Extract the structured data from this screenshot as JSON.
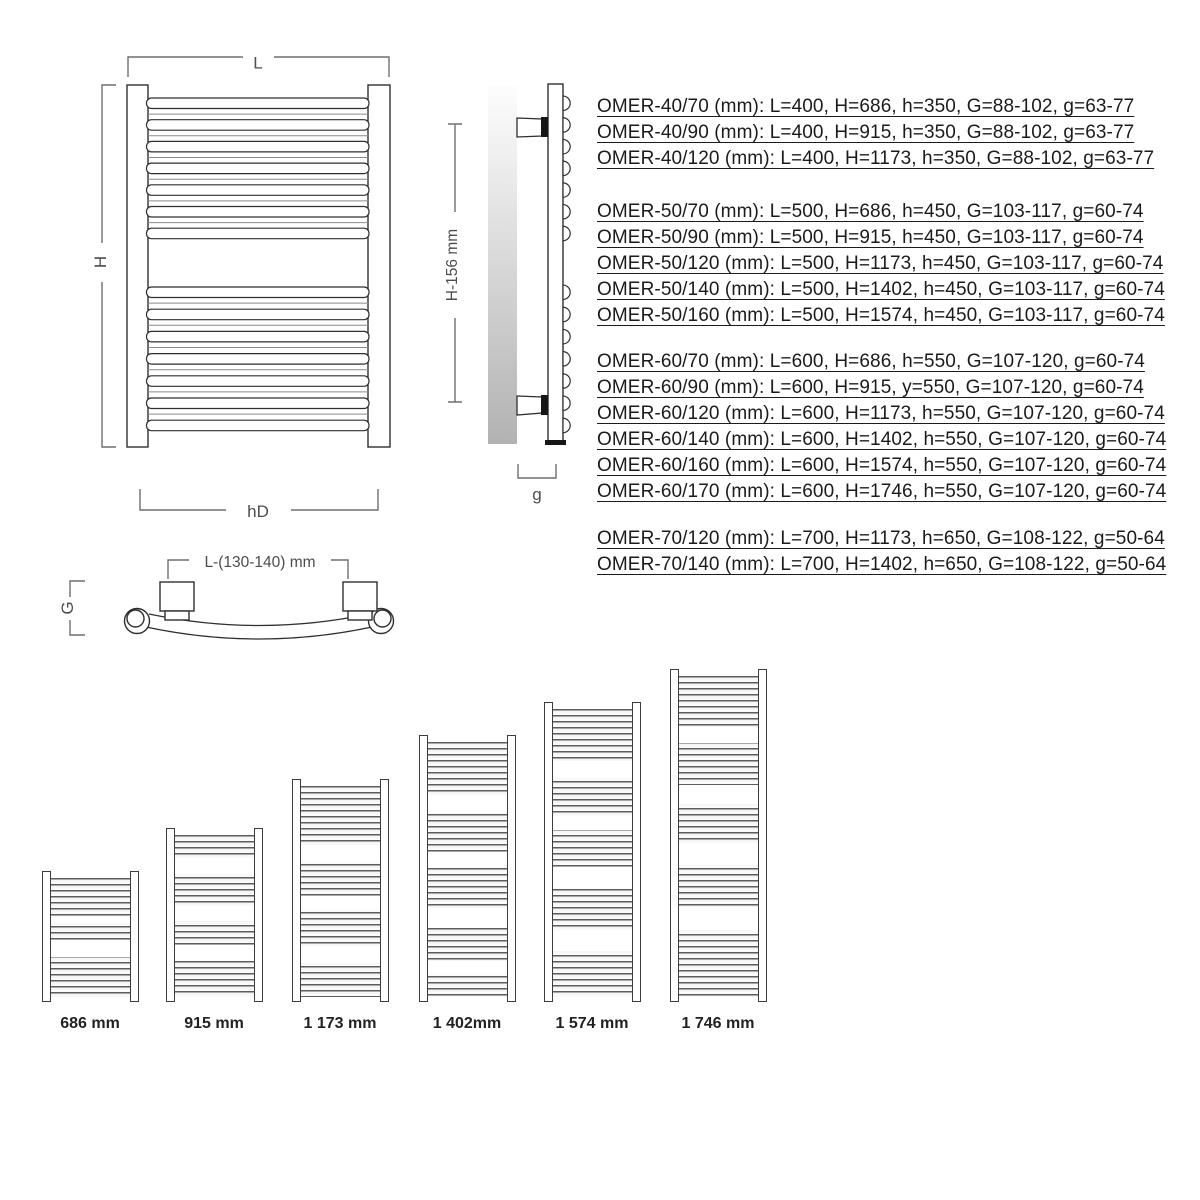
{
  "dimension_labels": {
    "front_width": "L",
    "front_height": "H",
    "front_bottom_width": "hD",
    "side_height": "H-156 mm",
    "side_depth": "g",
    "top_mount_spacing": "L-(130-140) mm",
    "top_depth": "G"
  },
  "spec_groups": [
    {
      "rows": [
        {
          "model": "OMER-40/70",
          "L": 400,
          "H": 686,
          "h": 350,
          "G": "88-102",
          "g": "63-77",
          "text": "OMER-40/70 (mm): L=400, H=686, h=350, G=88-102, g=63-77"
        },
        {
          "model": "OMER-40/90",
          "L": 400,
          "H": 915,
          "h": 350,
          "G": "88-102",
          "g": "63-77",
          "text": "OMER-40/90 (mm): L=400, H=915, h=350, G=88-102, g=63-77"
        },
        {
          "model": "OMER-40/120",
          "L": 400,
          "H": 1173,
          "h": 350,
          "G": "88-102",
          "g": "63-77",
          "text": "OMER-40/120 (mm): L=400, H=1173, h=350, G=88-102, g=63-77"
        }
      ]
    },
    {
      "rows": [
        {
          "model": "OMER-50/70",
          "L": 500,
          "H": 686,
          "h": 450,
          "G": "103-117",
          "g": "60-74",
          "text": "OMER-50/70 (mm): L=500, H=686, h=450, G=103-117, g=60-74"
        },
        {
          "model": "OMER-50/90",
          "L": 500,
          "H": 915,
          "h": 450,
          "G": "103-117",
          "g": "60-74",
          "text": "OMER-50/90 (mm): L=500, H=915, h=450, G=103-117, g=60-74"
        },
        {
          "model": "OMER-50/120",
          "L": 500,
          "H": 1173,
          "h": 450,
          "G": "103-117",
          "g": "60-74",
          "text": "OMER-50/120 (mm): L=500, H=1173, h=450, G=103-117, g=60-74"
        },
        {
          "model": "OMER-50/140",
          "L": 500,
          "H": 1402,
          "h": 450,
          "G": "103-117",
          "g": "60-74",
          "text": "OMER-50/140 (mm): L=500, H=1402, h=450, G=103-117, g=60-74"
        },
        {
          "model": "OMER-50/160",
          "L": 500,
          "H": 1574,
          "h": 450,
          "G": "103-117",
          "g": "60-74",
          "text": "OMER-50/160 (mm): L=500, H=1574, h=450, G=103-117, g=60-74"
        }
      ]
    },
    {
      "rows": [
        {
          "model": "OMER-60/70",
          "L": 600,
          "H": 686,
          "h": 550,
          "G": "107-120",
          "g": "60-74",
          "text": "OMER-60/70 (mm): L=600, H=686, h=550, G=107-120, g=60-74"
        },
        {
          "model": "OMER-60/90",
          "L": 600,
          "H": 915,
          "h": 550,
          "G": "107-120",
          "g": "60-74",
          "text": "OMER-60/90 (mm): L=600, H=915, y=550, G=107-120, g=60-74"
        },
        {
          "model": "OMER-60/120",
          "L": 600,
          "H": 1173,
          "h": 550,
          "G": "107-120",
          "g": "60-74",
          "text": "OMER-60/120 (mm): L=600, H=1173, h=550, G=107-120, g=60-74"
        },
        {
          "model": "OMER-60/140",
          "L": 600,
          "H": 1402,
          "h": 550,
          "G": "107-120",
          "g": "60-74",
          "text": "OMER-60/140 (mm): L=600, H=1402, h=550, G=107-120, g=60-74"
        },
        {
          "model": "OMER-60/160",
          "L": 600,
          "H": 1574,
          "h": 550,
          "G": "107-120",
          "g": "60-74",
          "text": "OMER-60/160 (mm): L=600, H=1574, h=550, G=107-120, g=60-74"
        },
        {
          "model": "OMER-60/170",
          "L": 600,
          "H": 1746,
          "h": 550,
          "G": "107-120",
          "g": "60-74",
          "text": "OMER-60/170 (mm): L=600, H=1746, h=550, G=107-120, g=60-74"
        }
      ]
    },
    {
      "rows": [
        {
          "model": "OMER-70/120",
          "L": 700,
          "H": 1173,
          "h": 650,
          "G": "108-122",
          "g": "50-64",
          "text": "OMER-70/120 (mm): L=700, H=1173, h=650, G=108-122, g=50-64"
        },
        {
          "model": "OMER-70/140",
          "L": 700,
          "H": 1402,
          "h": 650,
          "G": "108-122",
          "g": "50-64",
          "text": "OMER-70/140 (mm): L=700, H=1402, h=650, G=108-122, g=50-64"
        }
      ]
    }
  ],
  "height_series": [
    {
      "label": "686 mm",
      "mm": 686
    },
    {
      "label": "915 mm",
      "mm": 915
    },
    {
      "label": "1 173 mm",
      "mm": 1173
    },
    {
      "label": "1 402mm",
      "mm": 1402
    },
    {
      "label": "1 574 mm",
      "mm": 1574
    },
    {
      "label": "1 746 mm",
      "mm": 1746
    }
  ]
}
